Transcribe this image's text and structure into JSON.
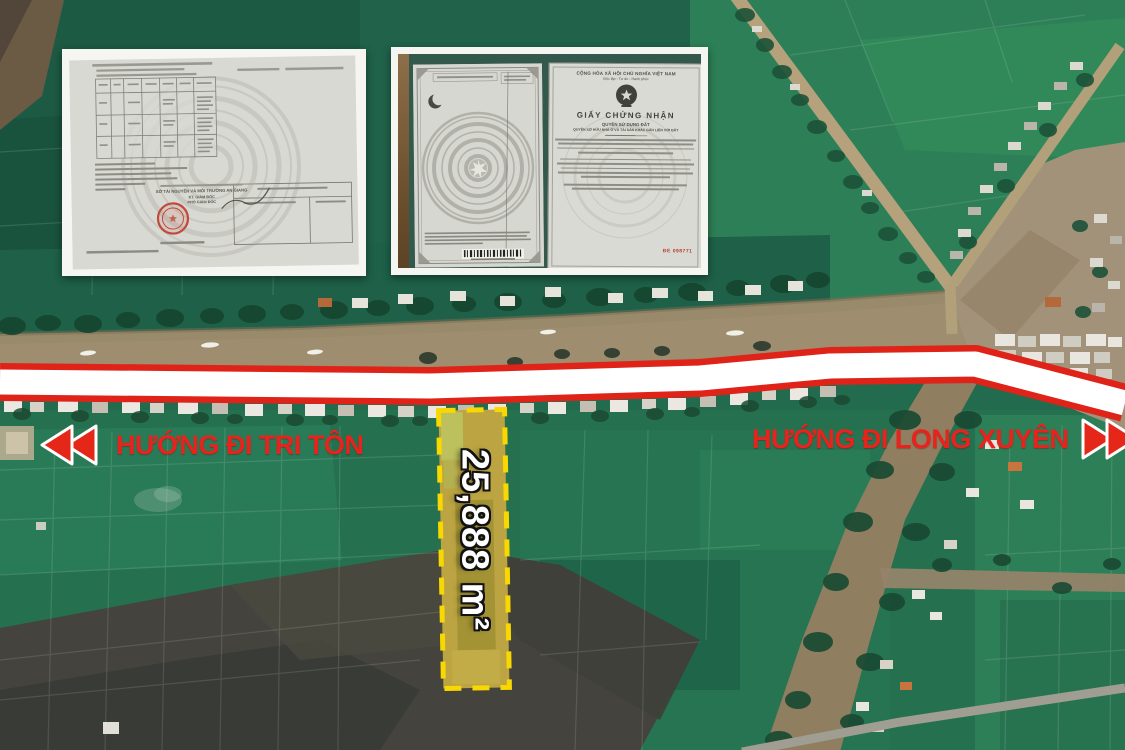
{
  "annotations": {
    "area_label": "25,888 m²",
    "direction_left": "HƯỚNG ĐI TRI TÔN",
    "direction_right": "HƯỚNG ĐI LONG XUYÊN"
  },
  "documents": {
    "left_page": {
      "issuer": "SỞ TÀI NGUYÊN VÀ MÔI TRƯỜNG AN GIANG",
      "sign_title1": "KT. GIÁM ĐỐC",
      "sign_title2": "PHÓ GIÁM ĐỐC"
    },
    "certificate": {
      "national_motto_line1": "CỘNG HÒA XÃ HỘI CHỦ NGHĨA VIỆT NAM",
      "national_motto_line2": "Độc lập - Tự do - Hạnh phúc",
      "title": "GIẤY CHỨNG NHẬN",
      "subtitle1": "QUYỀN SỬ DỤNG ĐẤT",
      "subtitle2": "QUYỀN SỞ HỮU NHÀ Ở VÀ TÀI SẢN KHÁC GẮN LIỀN VỚI ĐẤT",
      "serial": "ĐE 098771"
    }
  },
  "colors": {
    "accent_red": "#e8231d",
    "plot_yellow": "#f8d800",
    "road_band_red": "#e02318"
  }
}
